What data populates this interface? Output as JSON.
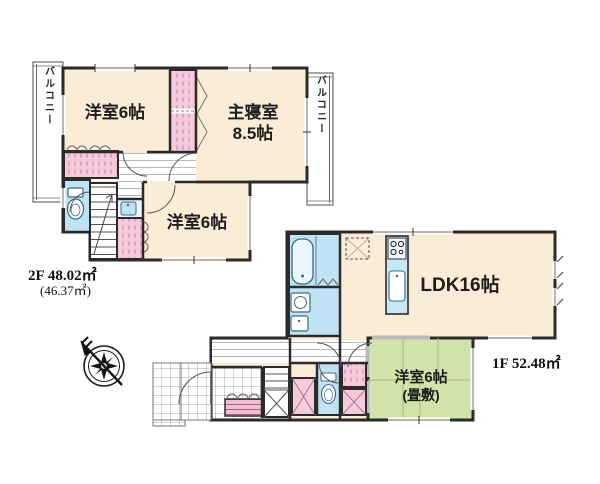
{
  "plan": {
    "floor2": {
      "area_label": "2F 48.02㎡",
      "area_sub_label": "(46.37㎡)",
      "rooms": {
        "west_room": "洋室6帖",
        "master_bedroom_line1": "主寝室",
        "master_bedroom_line2": "8.5帖",
        "south_room": "洋室6帖",
        "balcony_left": "バルコニー",
        "balcony_right": "バルコニー"
      }
    },
    "floor1": {
      "area_label": "1F 52.48㎡",
      "rooms": {
        "ldk": "LDK16帖",
        "tatami_room_line1": "洋室6帖",
        "tatami_room_line2": "(畳敷)"
      }
    },
    "icons": {
      "compass": "compass-rose",
      "toilet_2f": "toilet",
      "toilet_1f": "toilet",
      "bathtub": "bathtub",
      "washing_machine": "washing-machine",
      "washbasin": "washbasin",
      "kitchen_stove": "stove-burners",
      "kitchen_sink": "sink",
      "refrigerator_space": "refrigerator-dashed-box",
      "stairs_2f": "staircase",
      "stairs_1f": "staircase"
    },
    "colors": {
      "room_cream": "#fbecd5",
      "closet_pink": "#f7cadb",
      "wet_blue": "#bfe3f4",
      "kitchen_blue": "#c8e7f6",
      "tatami_green": "#cfe3ab",
      "wall_dark": "#2b2b2b",
      "window_gray": "#9a9a9a"
    }
  }
}
